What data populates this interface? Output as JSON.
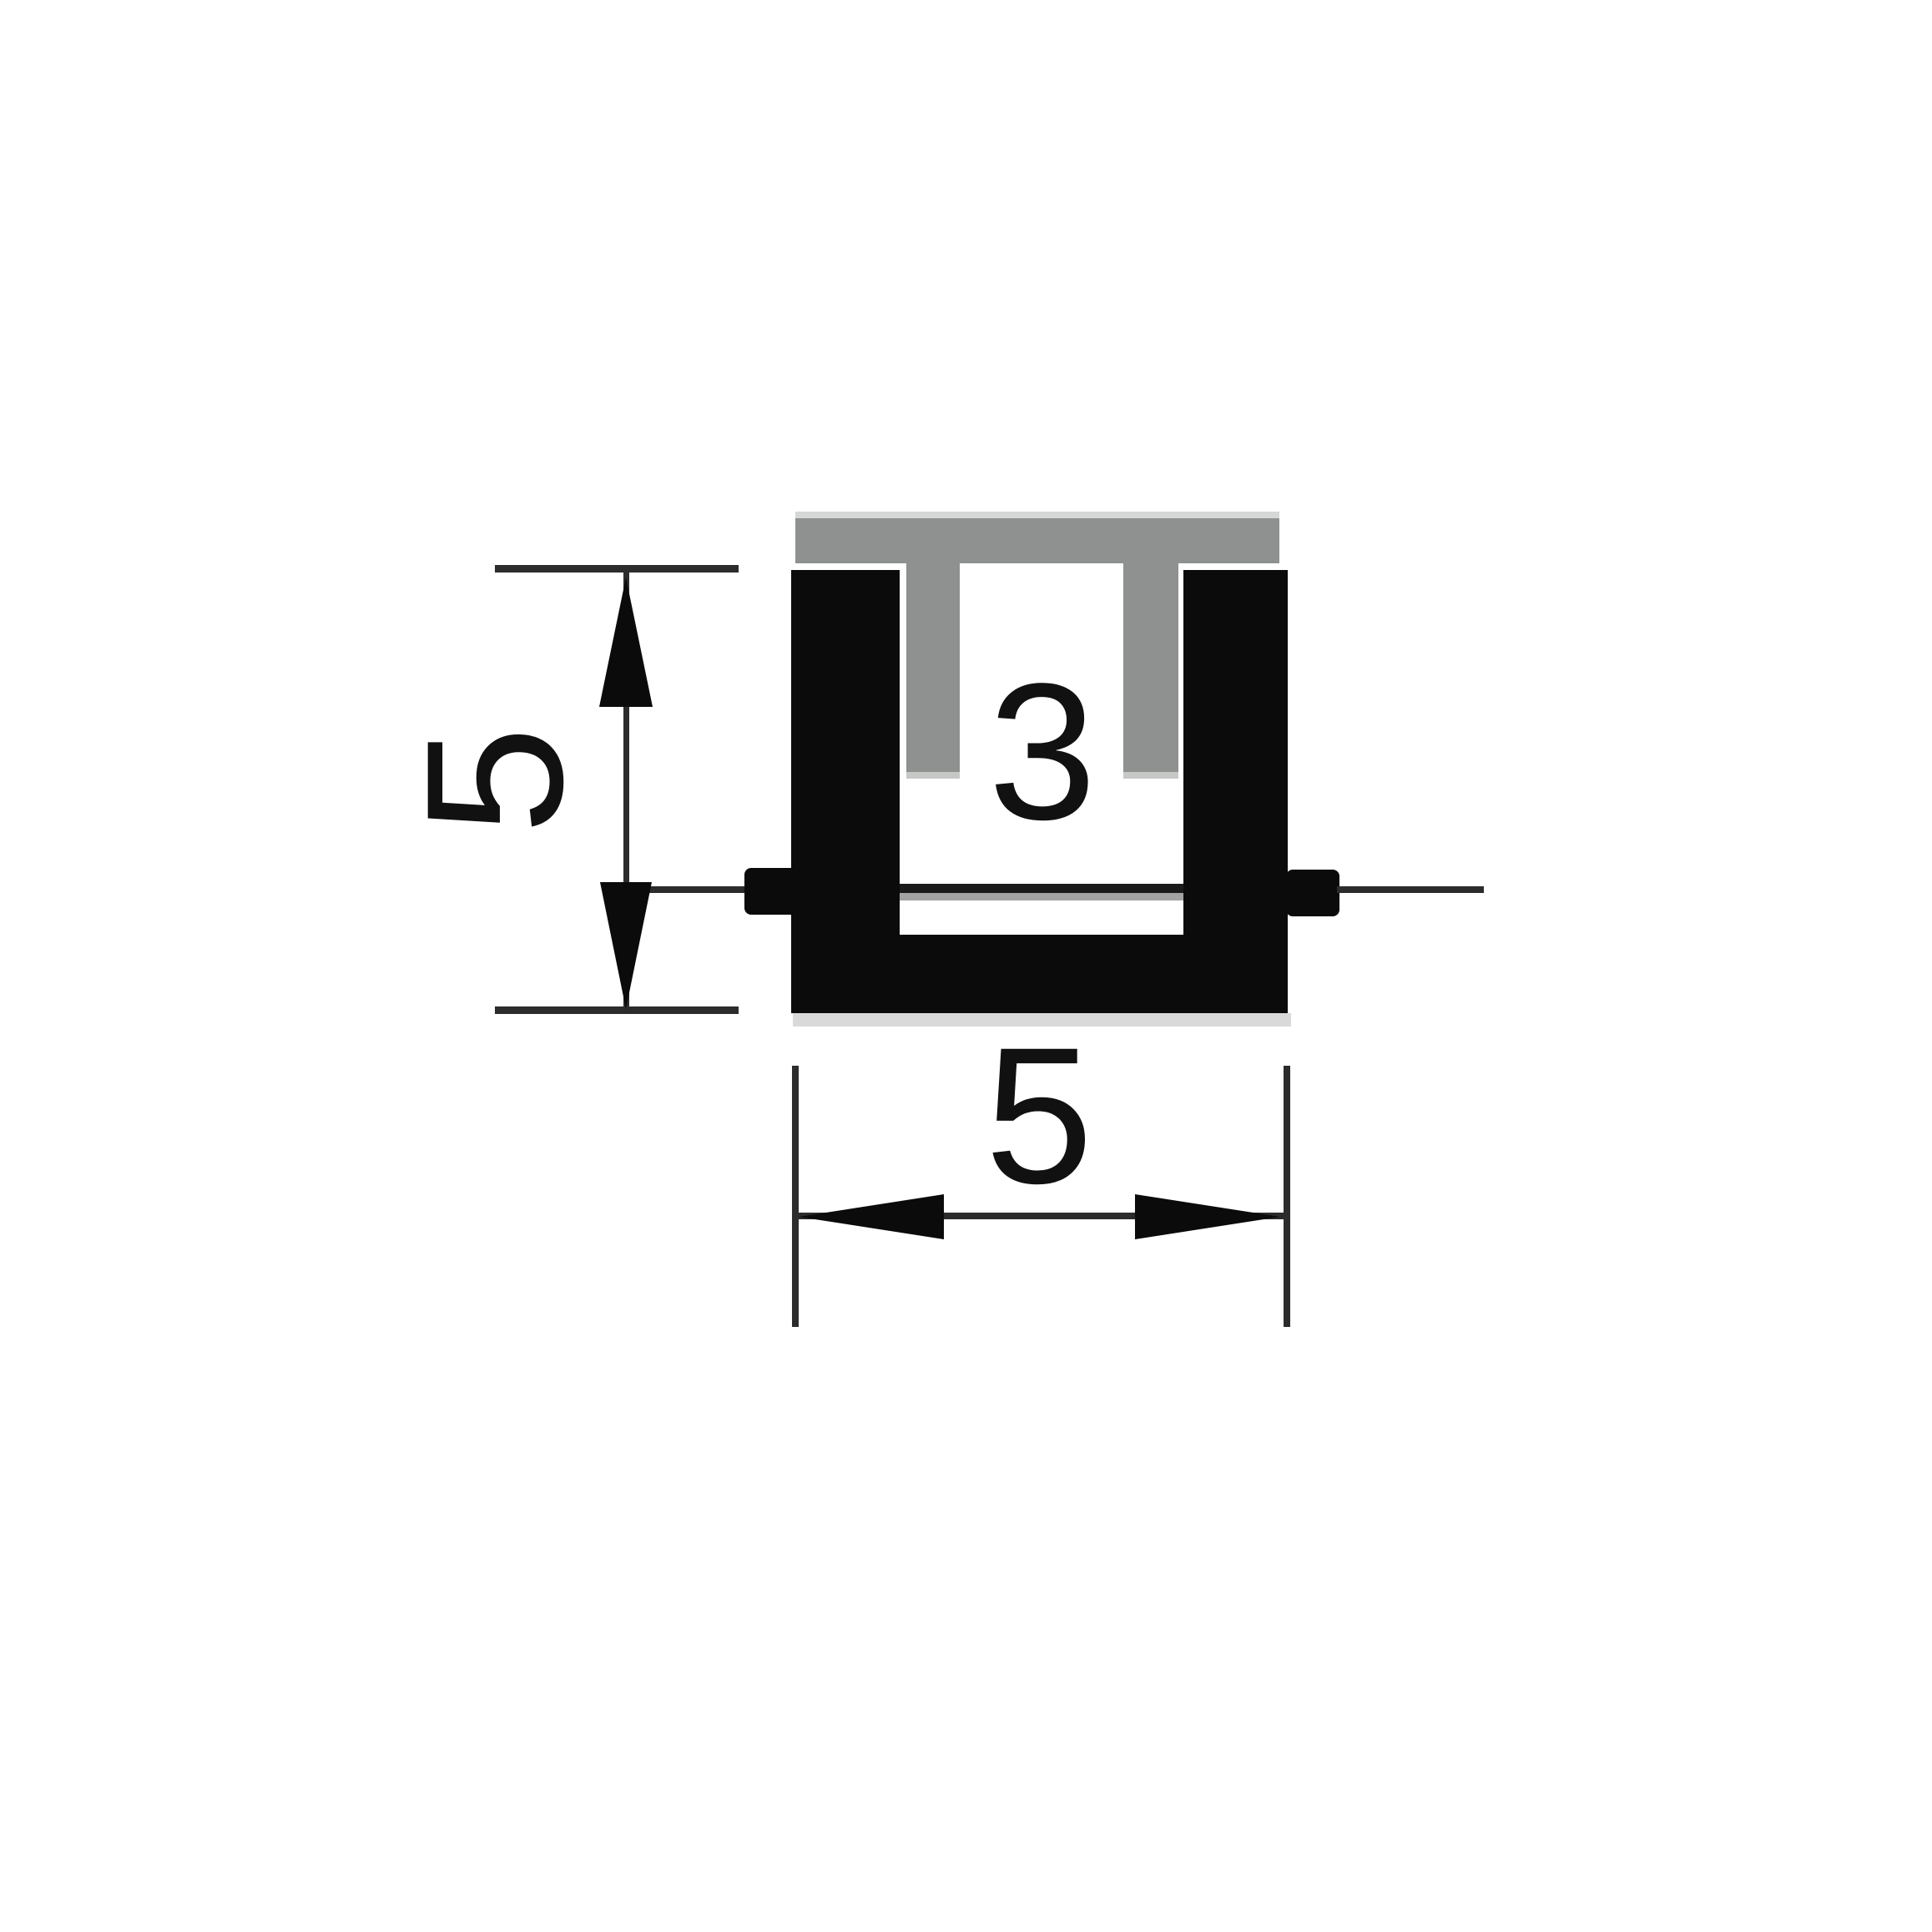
{
  "drawing": {
    "type": "technical-cross-section",
    "subject": "U-channel profile with insert cap",
    "dimensions": {
      "height": {
        "label": "5"
      },
      "width": {
        "label": "5"
      },
      "groove_width": {
        "label": "3"
      }
    },
    "colors": {
      "background": "#ffffff",
      "profile-black": "#0b0b0b",
      "insert-gray": "#8e918f",
      "insert-highlight": "#d5d8d6",
      "insert-leg-tip": "#c6c8c6",
      "line-dark": "#2c2c2c",
      "line-gray": "#a3a3a3",
      "shadow-gray": "#d9d9d9",
      "text-color": "#111111"
    }
  }
}
